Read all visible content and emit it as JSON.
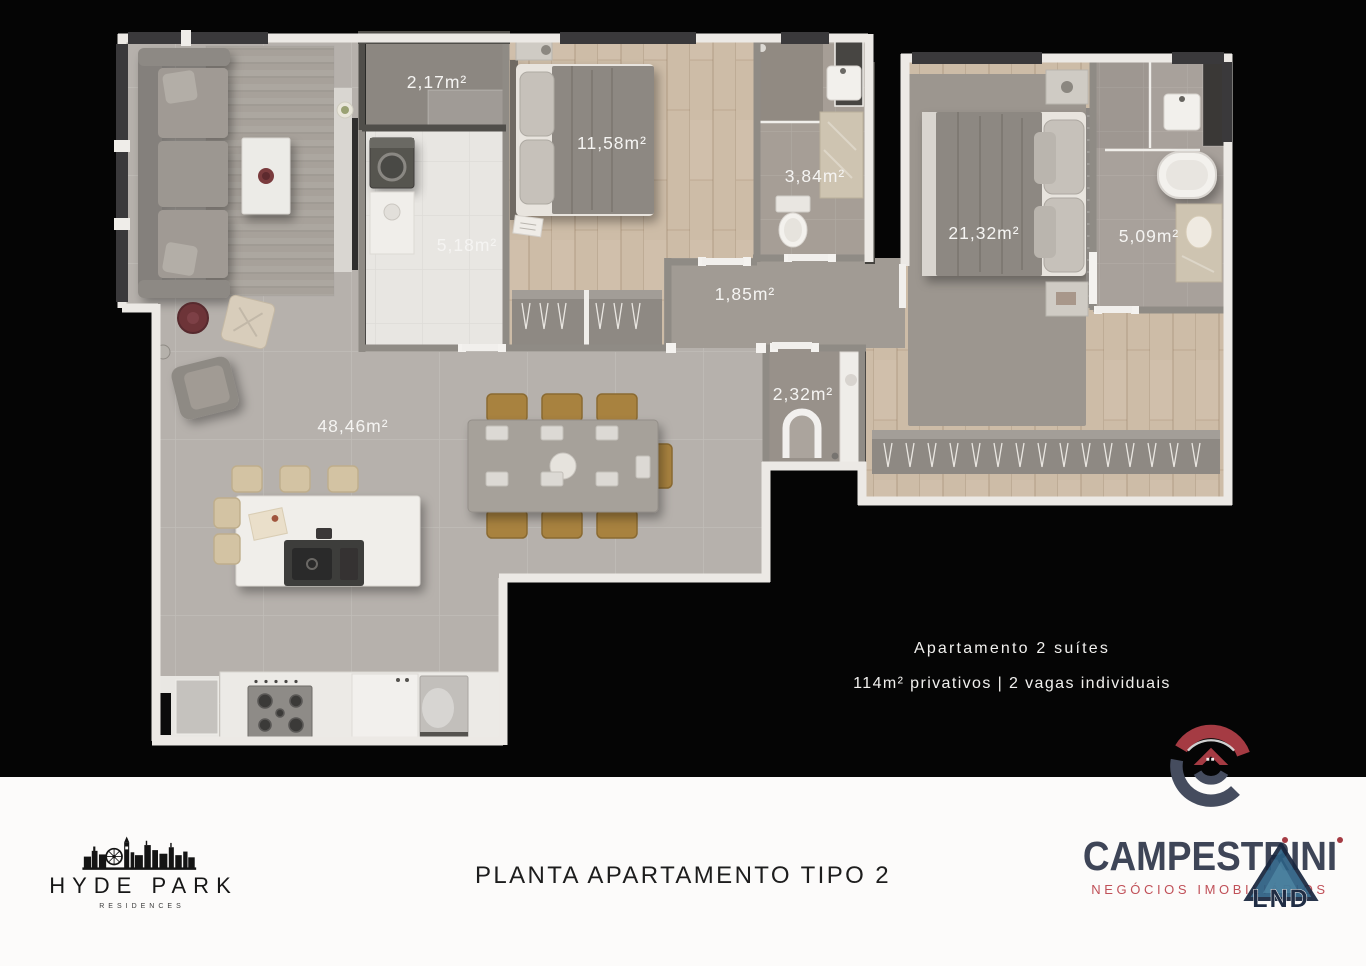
{
  "plan": {
    "rooms": [
      {
        "id": "storage-top",
        "area": "2,17m²"
      },
      {
        "id": "suite-1",
        "area": "11,58m²"
      },
      {
        "id": "bathroom-suite-1",
        "area": "3,84m²"
      },
      {
        "id": "laundry",
        "area": "5,18m²"
      },
      {
        "id": "master-suite",
        "area": "21,32m²"
      },
      {
        "id": "bathroom-master",
        "area": "5,09m²"
      },
      {
        "id": "hall",
        "area": "1,85m²"
      },
      {
        "id": "lavabo",
        "area": "2,32m²"
      },
      {
        "id": "living-kitchen",
        "area": "48,46m²"
      }
    ],
    "info": {
      "line1": "Apartamento 2 suítes",
      "line2": "114m² privativos | 2 vagas individuais"
    }
  },
  "footer": {
    "title": "PLANTA APARTAMENTO TIPO 2",
    "hyde_park": {
      "name": "HYDE PARK",
      "subtitle": "RESIDENCES"
    },
    "campestrini": {
      "name": "CAMPESTRINI",
      "subtitle": "NEGÓCIOS IMOBILIÁRIOS"
    },
    "lnd": {
      "label": "LND"
    }
  },
  "colors": {
    "background": "#050505",
    "footer_background": "#fcfbfa",
    "plan_label_text": "#f5f4f2",
    "brand_red": "#a53b43",
    "brand_slate": "#3e4557",
    "brand_rose": "#c05058",
    "brand_navy": "#19273f"
  }
}
